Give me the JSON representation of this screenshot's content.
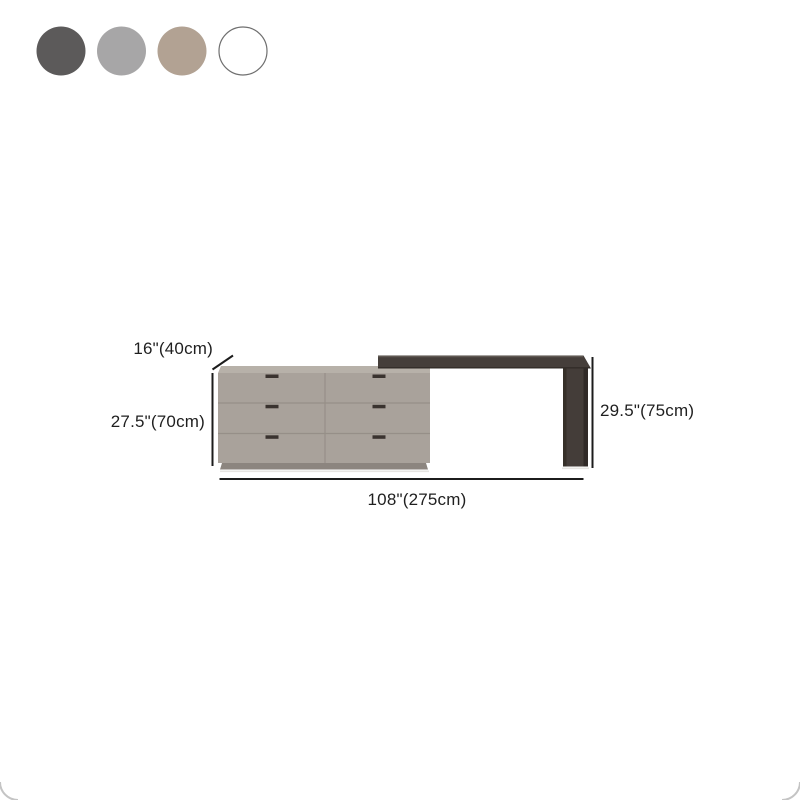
{
  "page": {
    "background": "#ffffff",
    "type": "product-dimension-diagram"
  },
  "swatches": {
    "items": [
      {
        "name": "dark-gray",
        "color": "#5c5a5a"
      },
      {
        "name": "light-gray",
        "color": "#a7a6a7"
      },
      {
        "name": "tan",
        "color": "#b2a293"
      },
      {
        "name": "white",
        "color": "#ffffff"
      }
    ]
  },
  "diagram": {
    "dimensions": {
      "depth": "16\"(40cm)",
      "dresser_height": "27.5\"(70cm)",
      "desk_height": "29.5\"(75cm)",
      "total_width": "108\"(275cm)"
    },
    "colors": {
      "dresser_front": "#a9a29b",
      "dresser_top": "#b7b1a9",
      "dresser_plinth": "#8c857f",
      "seam": "#968f88",
      "handle": "#3a332f",
      "desk_top": "#453e3a",
      "desk_top_highlight": "#5f5852",
      "desk_bottom_edge": "#322c28",
      "leg_front": "#443d39",
      "leg_right_edge": "#302a27",
      "leg_left_edge": "#363029",
      "floor_shadow": "#e6e4e1",
      "dimension_line": "#1c1c1c",
      "corner_arc": "#c4c4c4"
    }
  }
}
